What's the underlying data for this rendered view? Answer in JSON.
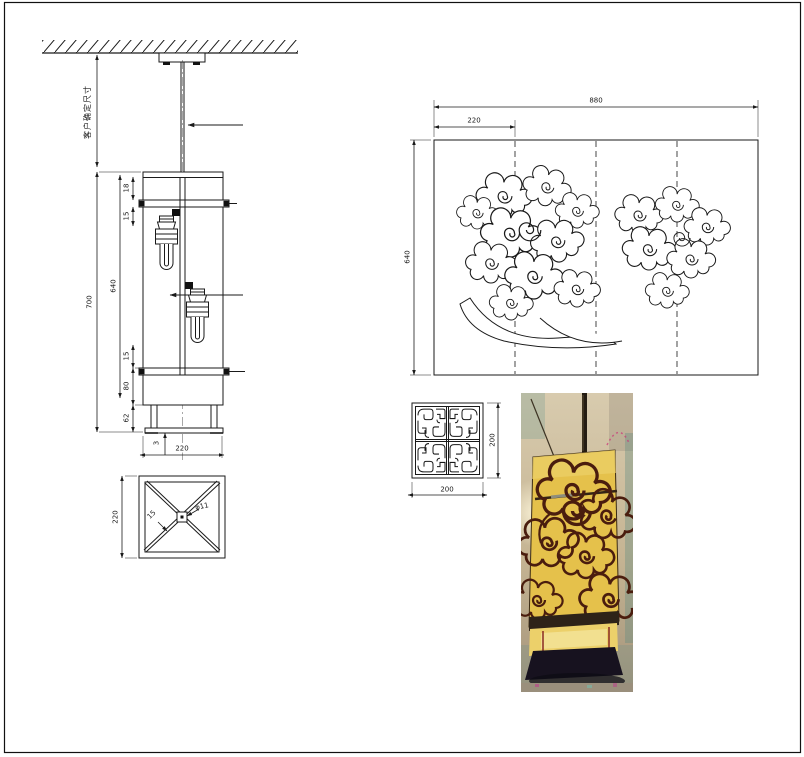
{
  "elevation": {
    "note_vertical": "客户确定尺寸",
    "dims": {
      "overall": "700",
      "body": "640",
      "top_band": "18",
      "upper_gap": "15",
      "lower_gap": "15",
      "lower_band": "80",
      "base": "62",
      "plate": "3",
      "width": "220"
    }
  },
  "plan": {
    "dims": {
      "side": "220",
      "strut": "15",
      "hole": "φ11"
    }
  },
  "pattern_panel": {
    "dims": {
      "total_width": "880",
      "segment": "220",
      "height": "640"
    }
  },
  "ornament_detail": {
    "dims": {
      "width": "200",
      "height": "200"
    }
  },
  "colors": {
    "line": "#1a1a1a",
    "lantern_yellow": "#e5c14b",
    "cloud_outline": "#4a1d0e",
    "photo_background": "#c9bb9e"
  }
}
